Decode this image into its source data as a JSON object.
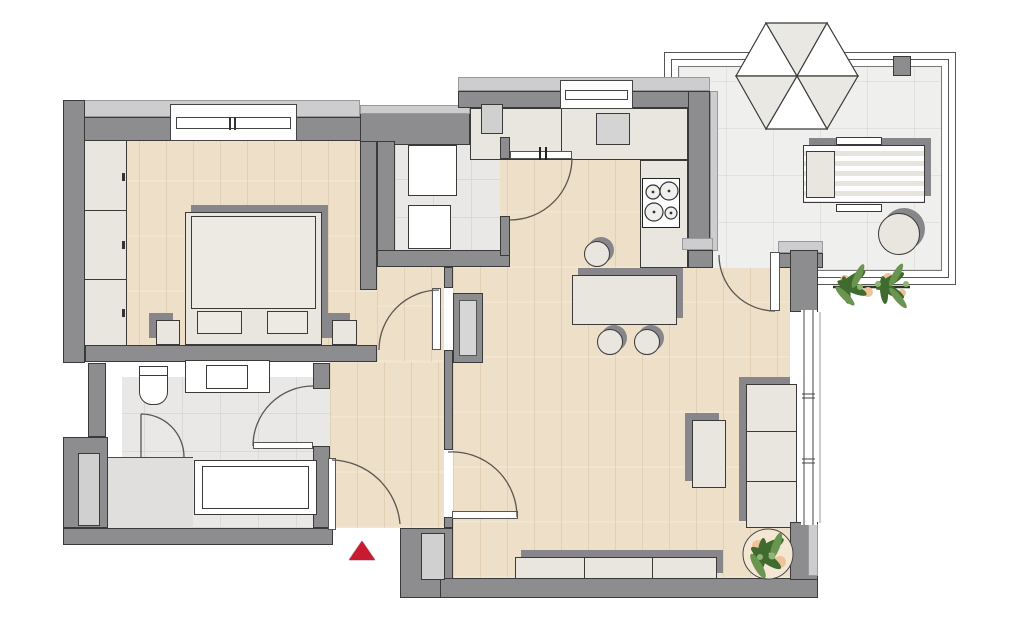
{
  "canvas": {
    "width": 1024,
    "height": 626
  },
  "colors": {
    "paper": "#ffffff",
    "wall": "#8d8c8e",
    "wall_light": "#cdcdcf",
    "outline": "#3a3a3a",
    "wood": "#eedfc8",
    "tile": "#e9e8e6",
    "tile_line": "#dad9d7",
    "shower_tile": "#e0dfdd",
    "terrace_tile": "#efefed",
    "furniture": "#e9e6e0",
    "furniture_shadow": "#87868a",
    "appliance_gray": "#d4d4d4",
    "arc": "#5a5550",
    "red": "#c81a31",
    "plant_dark": "#3f6b2e",
    "plant_mid": "#6a9550",
    "plant_light": "#8fb276",
    "plant_accent": "#eec39a"
  },
  "floorplan": {
    "type": "apartment-floor-plan",
    "entrance": {
      "marker": "red-triangle-arrow",
      "direction": "up"
    },
    "rooms": [
      {
        "name": "bedroom",
        "floor": "wood",
        "furniture": [
          "wardrobe",
          "double-bed",
          "pillow-left",
          "pillow-right",
          "nightstand-left",
          "nightstand-right"
        ],
        "openings": [
          "window-top"
        ]
      },
      {
        "name": "bathroom",
        "floor": "tile",
        "furniture": [
          "toilet",
          "washbasin-vanity",
          "bathtub",
          "shower"
        ],
        "openings": [
          "door-to-hallway",
          "shower-door"
        ]
      },
      {
        "name": "utility-room",
        "floor": "tile",
        "furniture": [
          "washing-machine",
          "dryer"
        ],
        "openings": [
          "door-to-kitchen"
        ]
      },
      {
        "name": "kitchen",
        "floor": "wood",
        "furniture": [
          "counter-l-shape",
          "sink",
          "cooktop-4-burners",
          "island",
          "bar-stool-1",
          "bar-stool-2",
          "bar-stool-3"
        ],
        "openings": [
          "window-top"
        ]
      },
      {
        "name": "hallway",
        "floor": "wood",
        "furniture": [
          "radiator"
        ],
        "openings": [
          "entrance-door",
          "door-to-bedroom",
          "door-to-living-room"
        ]
      },
      {
        "name": "living-room",
        "floor": "wood",
        "furniture": [
          "sofa-3-seat",
          "coffee-table",
          "sideboard",
          "potted-plant"
        ],
        "openings": [
          "terrace-door",
          "window-wall-right"
        ]
      },
      {
        "name": "terrace",
        "floor": "tile",
        "furniture": [
          "parasol",
          "sun-lounger",
          "side-table",
          "planter-plants"
        ],
        "openings": []
      }
    ]
  }
}
